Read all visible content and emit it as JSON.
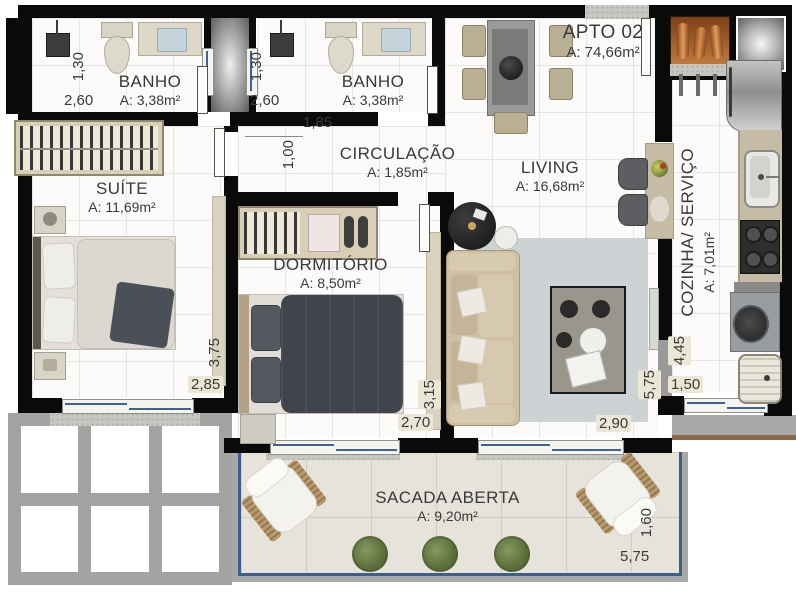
{
  "apartment": {
    "name": "APTO 02",
    "area": "A: 74,66m²"
  },
  "rooms": {
    "banho1": {
      "name": "BANHO",
      "area": "A: 3,38m²",
      "dim_w": "2,60",
      "dim_h": "1,30"
    },
    "banho2": {
      "name": "BANHO",
      "area": "A: 3,38m²",
      "dim_w": "2,60",
      "dim_h": "1,30"
    },
    "circulacao": {
      "name": "CIRCULAÇÃO",
      "area": "A: 1,85m²",
      "dim_w": "1,85",
      "dim_h": "1,00"
    },
    "suite": {
      "name": "SUÍTE",
      "area": "A: 11,69m²",
      "dim_w": "2,85",
      "dim_h": "3,75"
    },
    "dormitorio": {
      "name": "DORMITÓRIO",
      "area": "A: 8,50m²",
      "dim_w": "2,70",
      "dim_h": "3,15"
    },
    "living": {
      "name": "LIVING",
      "area": "A: 16,68m²",
      "dim_w": "2,90",
      "dim_h": "5,75"
    },
    "cozinha": {
      "name": "COZINHA/ SERVIÇO",
      "area": "A: 7,01m²",
      "dim_w": "1,50",
      "dim_h": "4,45"
    },
    "sacada": {
      "name": "SACADA ABERTA",
      "area": "A: 9,20m²",
      "dim_w": "5,75",
      "dim_h": "1,60"
    }
  },
  "colors": {
    "wall": "#0a0a0a",
    "window_glass": "#44618c",
    "balcony_rail": "#3f5e8a",
    "balcony_floor": "#e6e3da",
    "counter": "#c6bca6",
    "copper_shaft": "#b06a30",
    "text": "#3a3a3a"
  }
}
